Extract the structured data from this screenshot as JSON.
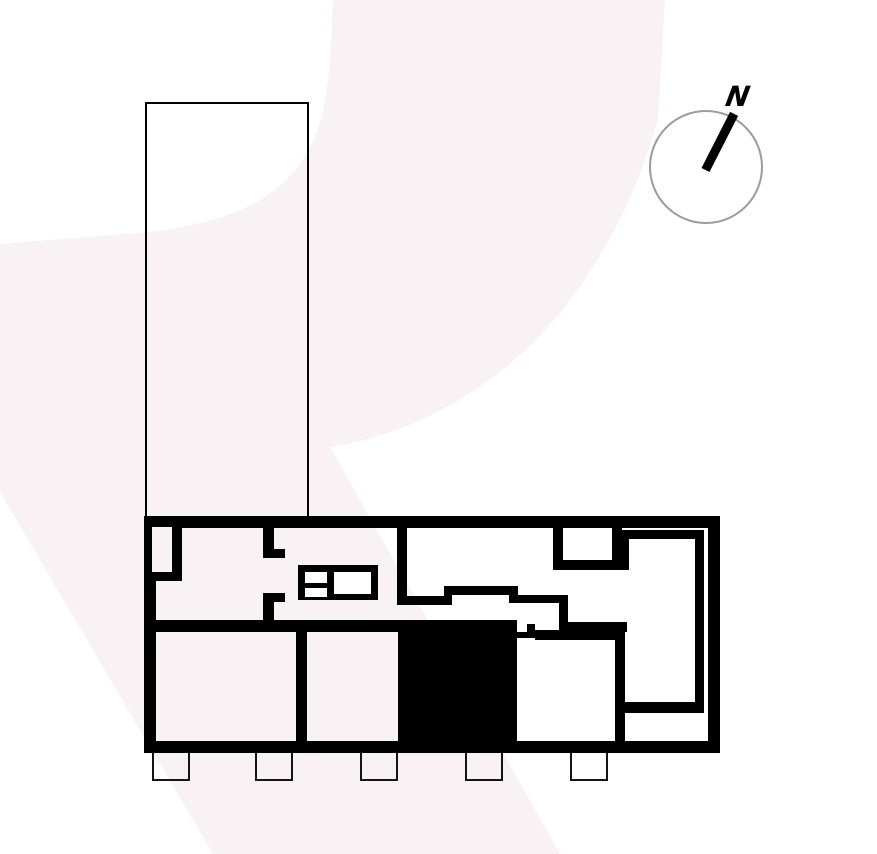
{
  "compass": {
    "label": "N"
  },
  "colors": {
    "wall": "#000000",
    "watermark": "#f8f2f4",
    "balcony_stroke": "#151515",
    "outline": "#000000",
    "compass_ring": "#9c9c9c",
    "background": "#ffffff"
  },
  "watermark": {
    "path": "M333,0 C328,120 330,210 150,232 L0,244 L0,492 L213,854 L560,854 L330,447 C470,425 600,320 658,120 L665,0 Z"
  },
  "floor_plan": {
    "walls": [
      [
        144,
        516,
        576,
        12
      ],
      [
        144,
        741,
        576,
        12
      ],
      [
        144,
        516,
        12,
        237
      ],
      [
        708,
        516,
        12,
        237
      ],
      [
        172,
        528,
        10,
        53
      ],
      [
        150,
        571,
        32,
        10
      ],
      [
        263,
        528,
        11,
        21
      ],
      [
        263,
        549,
        22,
        9
      ],
      [
        263,
        593,
        22,
        9
      ],
      [
        263,
        602,
        11,
        24
      ],
      [
        150,
        620,
        367,
        12
      ],
      [
        296,
        632,
        11,
        109
      ],
      [
        397,
        516,
        10,
        89
      ],
      [
        397,
        596,
        55,
        9
      ],
      [
        444,
        586,
        8,
        10
      ],
      [
        444,
        586,
        74,
        9
      ],
      [
        509,
        595,
        9,
        8
      ],
      [
        509,
        595,
        59,
        8
      ],
      [
        559,
        595,
        9,
        30
      ],
      [
        559,
        622,
        68,
        10
      ],
      [
        527,
        624,
        8,
        14
      ],
      [
        517,
        632,
        18,
        6
      ],
      [
        535,
        630,
        82,
        10
      ],
      [
        615,
        622,
        10,
        120
      ],
      [
        553,
        528,
        10,
        42
      ],
      [
        612,
        528,
        10,
        42
      ],
      [
        553,
        560,
        76,
        10
      ],
      [
        618,
        530,
        86,
        9
      ],
      [
        618,
        530,
        11,
        40
      ],
      [
        695,
        530,
        9,
        183
      ],
      [
        618,
        702,
        86,
        11
      ]
    ],
    "closet_slot": [
      150,
      527,
      22,
      45
    ],
    "furniture": {
      "frame": [
        298,
        565,
        80,
        35
      ],
      "cells": [
        [
          305,
          572,
          22,
          11
        ],
        [
          305,
          588,
          22,
          9
        ],
        [
          334,
          572,
          37,
          22
        ]
      ]
    },
    "highlight_room": [
      398,
      624,
      119,
      117
    ],
    "balconies": [
      [
        152,
        753,
        38,
        28
      ],
      [
        255,
        753,
        38,
        28
      ],
      [
        360,
        753,
        38,
        28
      ],
      [
        465,
        753,
        38,
        28
      ],
      [
        570,
        753,
        38,
        28
      ]
    ],
    "building_outline": [
      145,
      102,
      164,
      418
    ]
  }
}
